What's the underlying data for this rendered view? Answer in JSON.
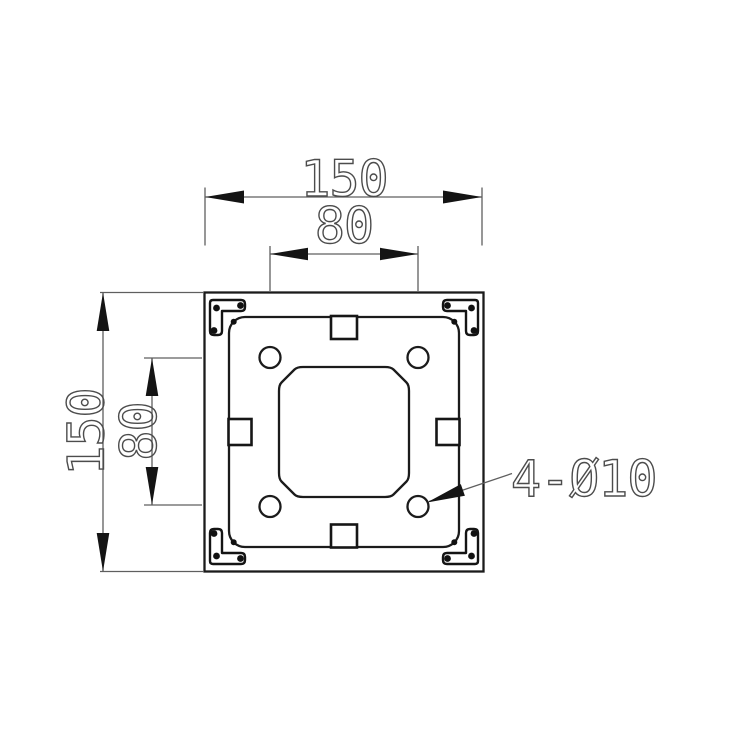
{
  "drawing": {
    "view": "base-plate-top-view",
    "colors": {
      "background": "#ffffff",
      "body_line": "#1b1b1b",
      "dimension_line": "#5f5f5f",
      "dimension_text": "#4c4c4c",
      "arrow_fill": "#141414"
    },
    "dimensions": {
      "plate_width": {
        "text": "150",
        "orientation": "horizontal"
      },
      "hole_spacing_horizontal": {
        "text": "80",
        "orientation": "horizontal"
      },
      "plate_height": {
        "text": "150",
        "orientation": "vertical"
      },
      "hole_spacing_vertical": {
        "text": "80",
        "orientation": "vertical"
      },
      "hole_callout": {
        "text": "4-Ø10"
      }
    },
    "part": {
      "plate_size_mm": 150,
      "hole_pattern_spacing_mm": 80,
      "hole_count": 4,
      "hole_diameter_mm": 10
    }
  }
}
